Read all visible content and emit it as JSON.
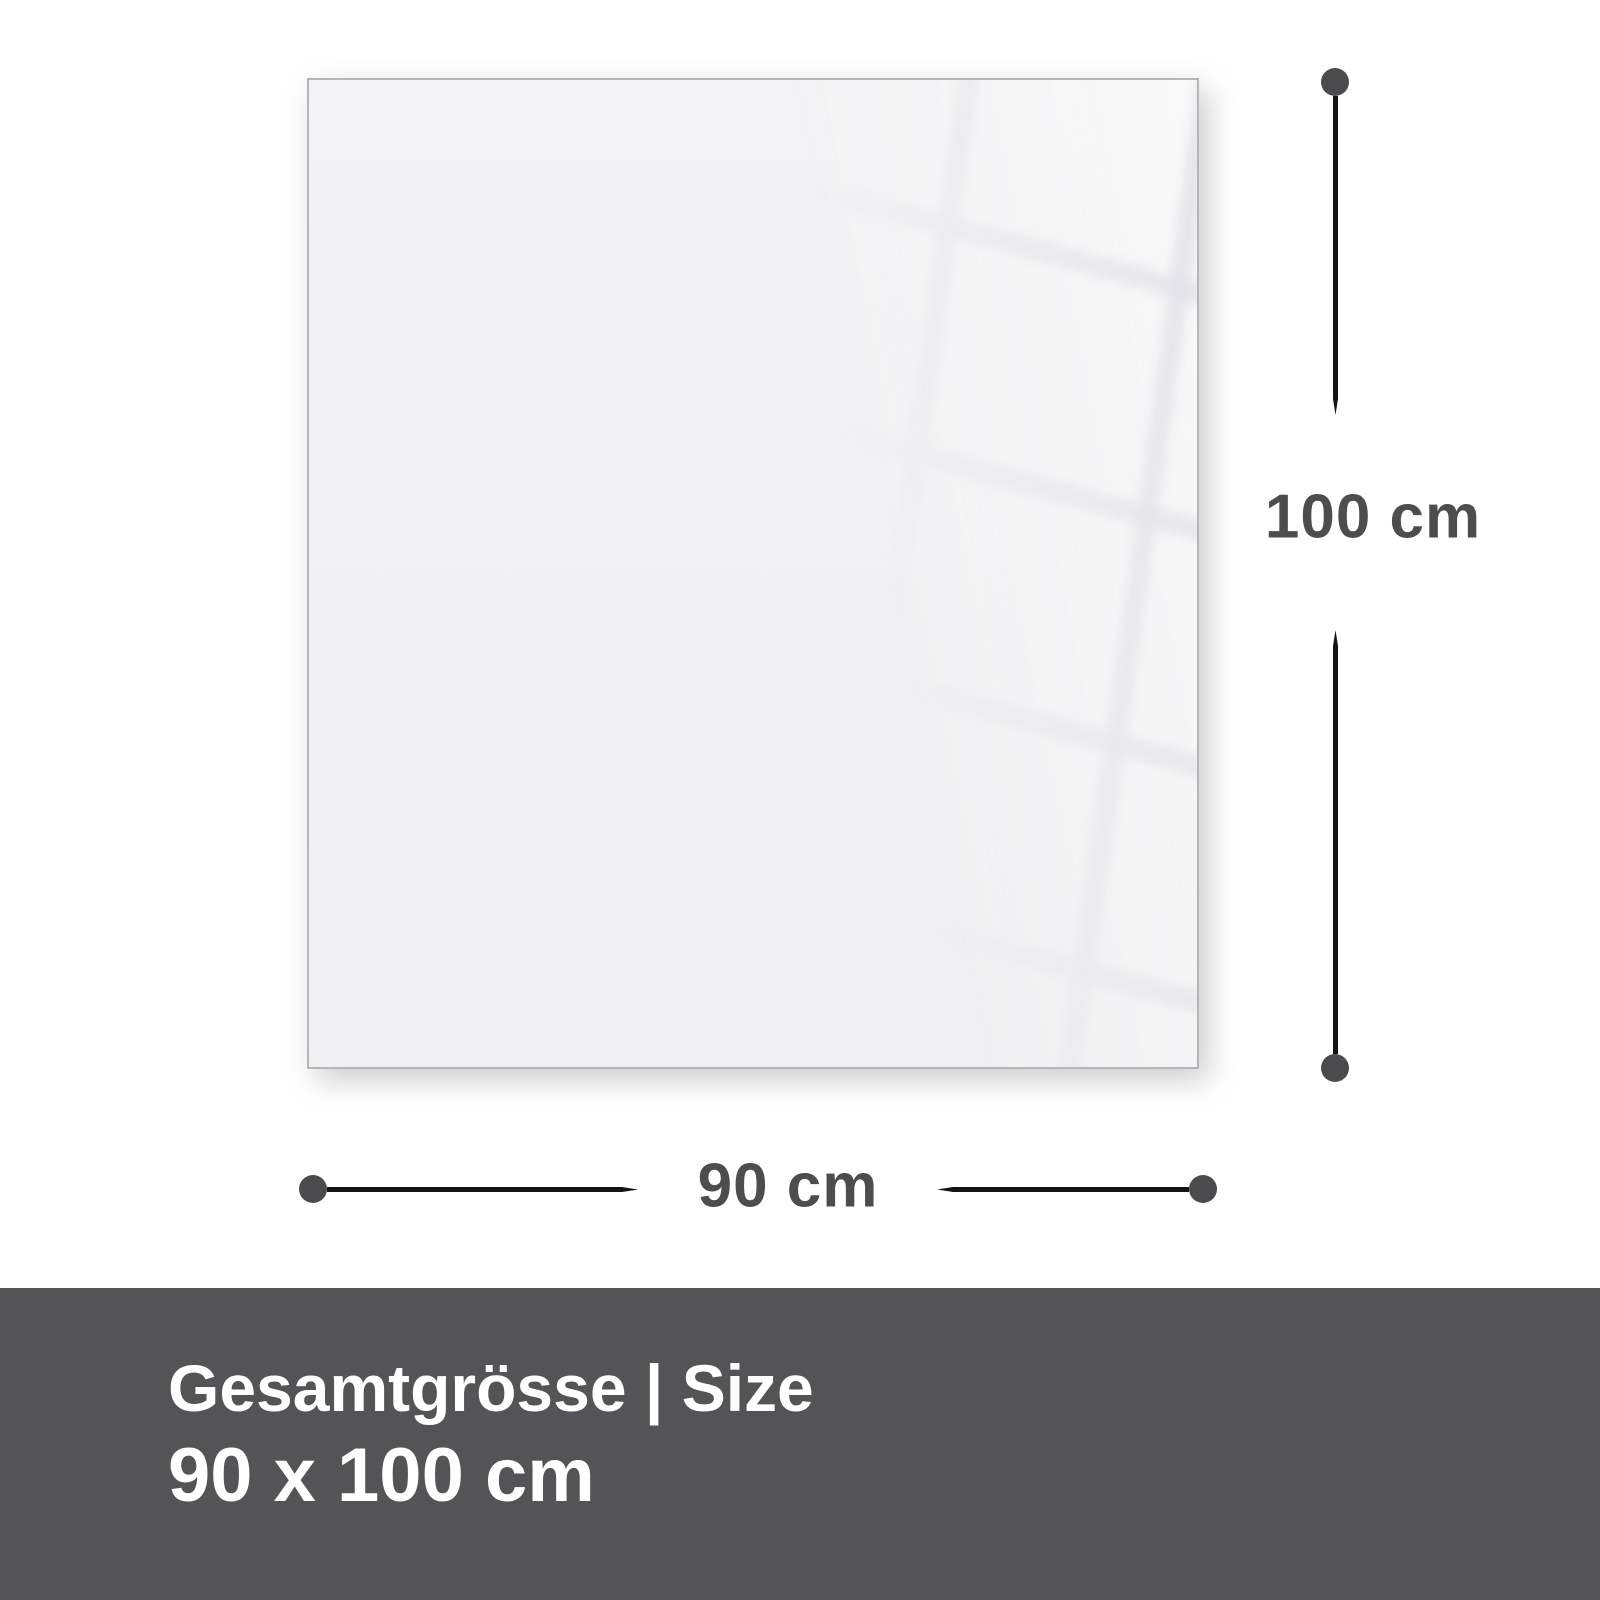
{
  "diagram": {
    "height_dimension": {
      "label": "100 cm"
    },
    "width_dimension": {
      "label": "90 cm"
    },
    "colors": {
      "panel_fill": "#f1f1f3",
      "panel_border": "#b6b6b8",
      "dimension_line": "#141414",
      "dimension_dot": "#4b4b4d",
      "dimension_label_text": "#4d4d4d"
    }
  },
  "footer": {
    "title": "Gesamtgrösse | Size",
    "size_value": "90 x 100 cm",
    "colors": {
      "background": "#545456",
      "text": "#ffffff"
    }
  }
}
